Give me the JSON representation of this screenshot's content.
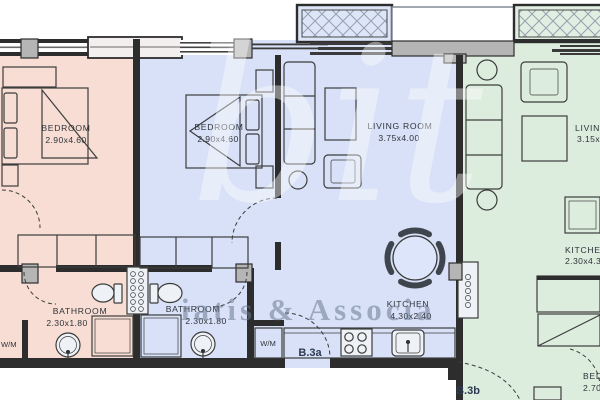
{
  "title": "apartment-floor-plan",
  "colors": {
    "unit_a_floor": "#f7ddd4",
    "unit_b_floor": "#d8e1f7",
    "unit_c_floor": "#dcedde",
    "balcony_b": "#dde5f8",
    "balcony_c": "#e1efe3",
    "wall": "#2d2d2d",
    "line": "#3c3c3c",
    "gray_element": "#b5b5b5",
    "watermark_text": "#6c7b93",
    "unit_label": "#2b3a52"
  },
  "units": {
    "a": {
      "bedroom_name": "BEDROOM",
      "bedroom_dims": "2.90x4.60",
      "bathroom_name": "BATHROOM",
      "bathroom_dims": "2.30x1.80",
      "wm_label": "W/M"
    },
    "b": {
      "bedroom_name": "BEDROOM",
      "bedroom_dims": "2.90x4.60",
      "living_name": "LIVING ROOM",
      "living_dims": "3.75x4.00",
      "bathroom_name": "BATHROOM",
      "bathroom_dims": "2.30x1.80",
      "kitchen_name": "KITCHEN",
      "kitchen_dims": "4.30x2.40",
      "wm_label": "W/M",
      "unit_label": "B.3a"
    },
    "c": {
      "living_name": "LIVING",
      "living_dims": "3.15x",
      "kitchen_name": "KITCHEN",
      "kitchen_dims": "2.30x4.3",
      "bedroom_name": "BED",
      "bedroom_dims": "2.70",
      "unit_label": "B.3b"
    }
  },
  "watermark": {
    "logo": "bit",
    "text": "iatis & Associa"
  }
}
